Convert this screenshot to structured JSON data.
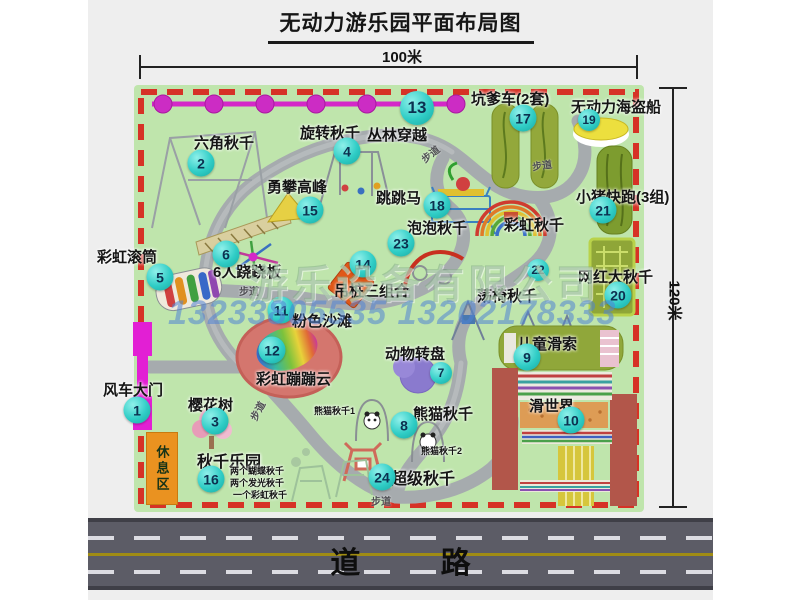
{
  "title": "无动力游乐园平面布局图",
  "dimensions": {
    "width": "100米",
    "height": "120米"
  },
  "road_label": "道 路",
  "watermark": {
    "company": "游乐设备有限公司",
    "phone": "13233805535 13202178333"
  },
  "rest_area_label": "休息区",
  "colors": {
    "map_bg": "#bfe5ac",
    "border_dash": "#d63226",
    "badge": "#30cdc6",
    "zipline": "#d428c8",
    "gate": "#e21fd4",
    "road": "#5c5c66",
    "rest_area": "#ea9220",
    "slide_red": "#b2564a"
  },
  "map": {
    "attractions": [
      {
        "num": "1",
        "name": "风车大门",
        "badge": [
          137,
          410
        ],
        "label": [
          103,
          379
        ]
      },
      {
        "num": "2",
        "name": "六角秋千",
        "badge": [
          201,
          163
        ],
        "label": [
          194,
          132
        ]
      },
      {
        "num": "3",
        "name": "樱花树",
        "badge": [
          215,
          421
        ],
        "label": [
          188,
          394
        ]
      },
      {
        "num": "4",
        "name": "旋转秋千",
        "badge": [
          347,
          151
        ],
        "label": [
          300,
          122
        ]
      },
      {
        "num": "5",
        "name": "彩虹滚筒",
        "badge": [
          160,
          277
        ],
        "label": [
          97,
          246
        ]
      },
      {
        "num": "6",
        "name": "6人跷跷板",
        "badge": [
          226,
          254
        ],
        "label": [
          213,
          261
        ]
      },
      {
        "num": "7",
        "name": "动物转盘",
        "badge": [
          441,
          373
        ],
        "size": "sm",
        "label": [
          385,
          343
        ]
      },
      {
        "num": "8",
        "name": "熊猫秋千",
        "badge": [
          404,
          425
        ],
        "label": [
          413,
          403
        ]
      },
      {
        "num": "9",
        "name": "儿童滑索",
        "badge": [
          527,
          357
        ],
        "label": [
          517,
          333
        ]
      },
      {
        "num": "10",
        "name": "滑世界",
        "badge": [
          571,
          420
        ],
        "label": [
          529,
          395
        ]
      },
      {
        "num": "11",
        "name": "粉色沙滩",
        "badge": [
          281,
          310
        ],
        "label": [
          292,
          310
        ]
      },
      {
        "num": "12",
        "name": "彩虹蹦蹦云",
        "badge": [
          272,
          350
        ],
        "label": [
          256,
          368
        ]
      },
      {
        "num": "13",
        "name": "丛林穿越",
        "badge": [
          417,
          108
        ],
        "size": "lg",
        "label": [
          367,
          124
        ]
      },
      {
        "num": "14",
        "name": "吊桩三组合",
        "badge": [
          363,
          264
        ],
        "label": [
          334,
          280
        ]
      },
      {
        "num": "15",
        "name": "勇攀高峰",
        "badge": [
          310,
          210
        ],
        "label": [
          267,
          176
        ]
      },
      {
        "num": "16",
        "name": "秋千乐园",
        "badge": [
          211,
          479
        ],
        "label": [
          197,
          448
        ],
        "label_size": 16
      },
      {
        "num": "17",
        "name": "坑爹车(2套)",
        "badge": [
          523,
          118
        ],
        "label": [
          471,
          88
        ]
      },
      {
        "num": "18",
        "name": "跳跳马",
        "badge": [
          437,
          205
        ],
        "label": [
          376,
          187
        ]
      },
      {
        "num": "19",
        "name": "无动力海盗船",
        "badge": [
          589,
          120
        ],
        "size": "sm",
        "label": [
          571,
          96
        ]
      },
      {
        "num": "20",
        "name": "网红大秋千",
        "badge": [
          618,
          295
        ],
        "label": [
          578,
          266
        ]
      },
      {
        "num": "21",
        "name": "小猪快跑(3组)",
        "badge": [
          603,
          210
        ],
        "label": [
          576,
          186
        ]
      },
      {
        "num": "22",
        "name": "荡椅秋千",
        "badge": [
          538,
          270
        ],
        "size": "sm",
        "label": [
          477,
          285
        ]
      },
      {
        "num": "23",
        "name": "泡泡秋千",
        "badge": [
          401,
          243
        ],
        "label": [
          407,
          217
        ]
      },
      {
        "num": "24",
        "name": "超级秋千",
        "badge": [
          382,
          477
        ],
        "label": [
          391,
          465
        ],
        "label_size": 16
      }
    ],
    "extra_labels": [
      {
        "name": "彩虹秋千",
        "pos": [
          504,
          214
        ]
      },
      {
        "name": "熊猫秋千1",
        "pos": [
          314,
          404
        ],
        "small": true
      },
      {
        "name": "熊猫秋千2",
        "pos": [
          421,
          444
        ],
        "small": true
      },
      {
        "name": "两个蝴蝶秋千",
        "pos": [
          230,
          464
        ],
        "small": true
      },
      {
        "name": "两个发光秋千",
        "pos": [
          230,
          476
        ],
        "small": true
      },
      {
        "name": "一个彩虹秋千",
        "pos": [
          233,
          488
        ],
        "small": true
      }
    ],
    "path_labels": [
      {
        "name": "步道",
        "pos": [
          420,
          146
        ],
        "rot": -38
      },
      {
        "name": "步道",
        "pos": [
          532,
          157
        ],
        "rot": -8
      },
      {
        "name": "步道",
        "pos": [
          239,
          283
        ],
        "rot": 0
      },
      {
        "name": "步道",
        "pos": [
          247,
          403
        ],
        "rot": -62
      },
      {
        "name": "步道",
        "pos": [
          371,
          493
        ],
        "rot": 0
      }
    ]
  }
}
